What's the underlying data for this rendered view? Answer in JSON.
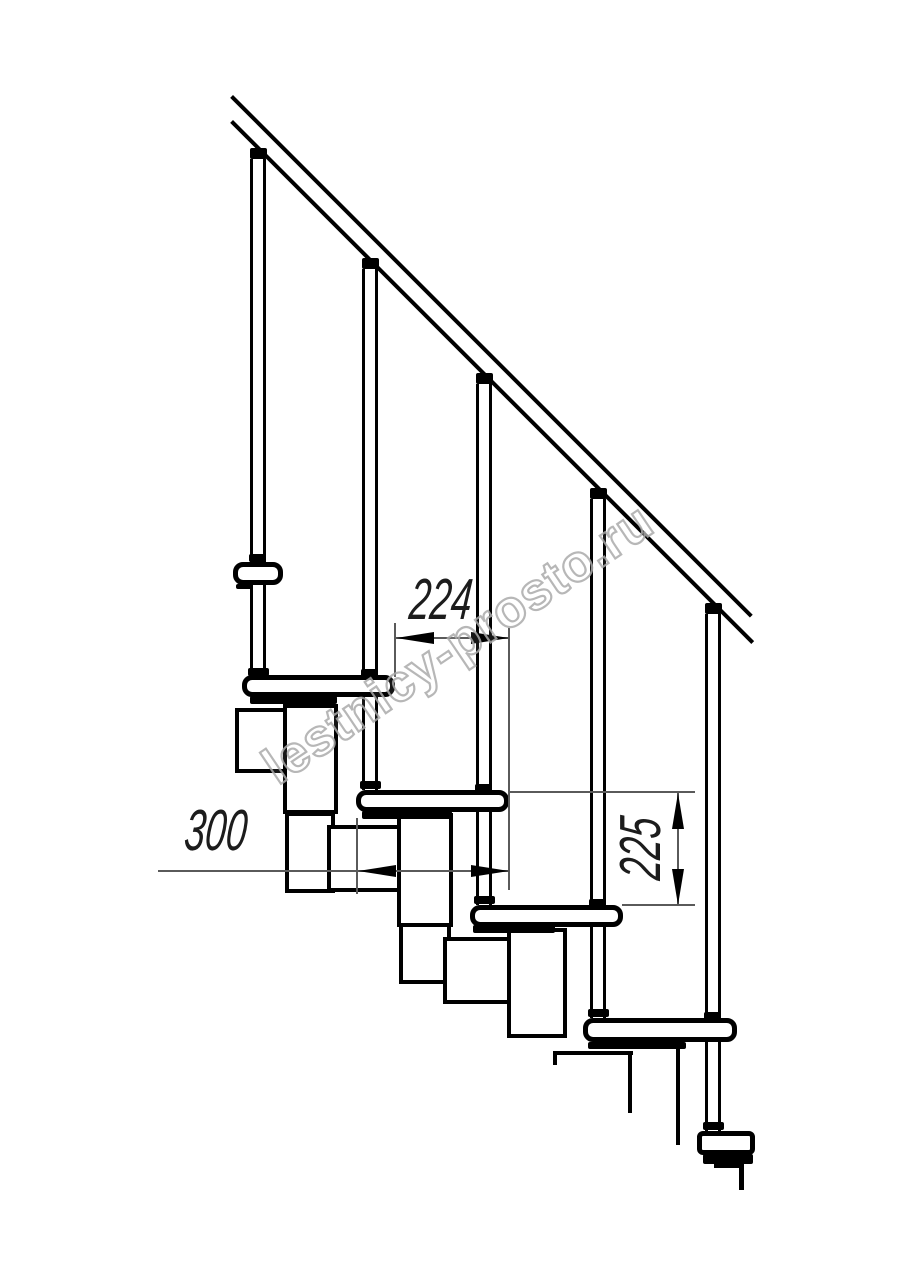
{
  "figure": {
    "watermark": "lestnicy-prosto.ru",
    "dimensions": {
      "going": {
        "label": "224",
        "value": 224
      },
      "tread_length": {
        "label": "300",
        "value": 300
      },
      "rise": {
        "label": "225",
        "value": 225
      }
    },
    "colors": {
      "line": "#000000",
      "dimension_line": "#5a5a5a",
      "text": "#1c1c1c",
      "watermark": "#ababab",
      "background": "#ffffff"
    }
  }
}
